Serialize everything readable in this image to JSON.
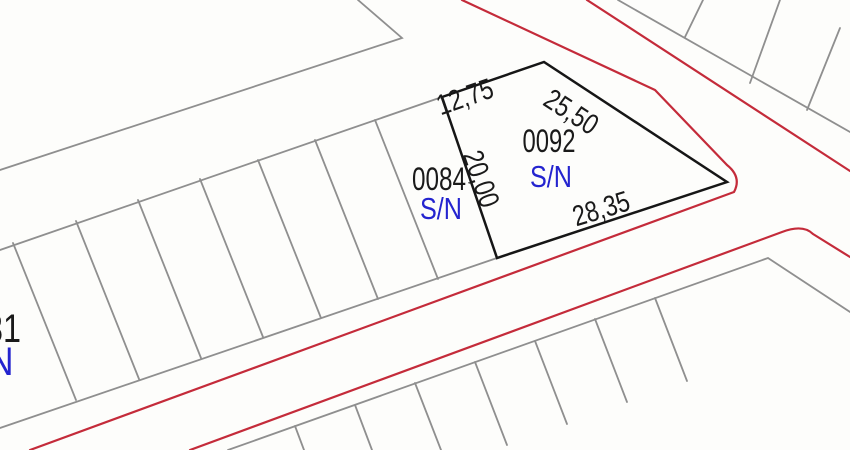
{
  "map": {
    "type": "cadastral-parcel-map",
    "colors": {
      "background": "#fdfdfb",
      "parcel_number_black": "#1a1a1a",
      "status_blue": "#2424cf",
      "road_red": "#c42b3a",
      "boundary_gray": "#8f8f8f",
      "parcel_outline_black": "#161616"
    },
    "parcels": [
      {
        "id": "0092",
        "status": "S/N",
        "dimensions": {
          "north": "12,75",
          "northeast": "25,50",
          "south": "28,35",
          "west": "20,00"
        }
      },
      {
        "id": "0084",
        "status": "S/N"
      },
      {
        "id_partial": "31",
        "status_partial": "N"
      }
    ]
  }
}
